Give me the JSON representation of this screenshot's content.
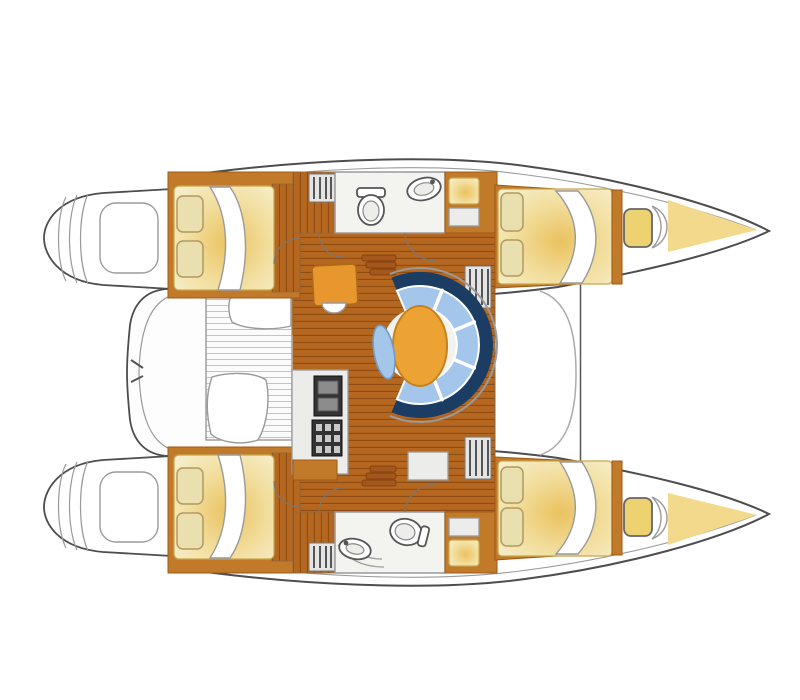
{
  "page": {
    "title": "Catamaran floor plan — top view with twin hulls, bows to the right, central saloon dinette, galley, two heads, four double berths, aft cockpit and stern swim platforms"
  },
  "colors": {
    "outline": "#4d4d4d",
    "lineLight": "#9a9a9a",
    "wood": "#b5671f",
    "woodLine": "#8f4c13",
    "trim": "#c1792a",
    "trimDark": "#a05a14",
    "mattress": "#f6ecc8",
    "mattressGlow": "#eac25f",
    "pillow": "#eadfae",
    "pillowEdge": "#b3995e",
    "sofaNavy": "#1b3c63",
    "sofaBlue": "#a4c6ea",
    "sofaBlueEdge": "#6f9cc9",
    "tableOrange": "#eda334",
    "tableEdge": "#c5821c",
    "bath": "#f3f3f0",
    "counter": "#ececea",
    "stove": "#333333",
    "stoveGrid": "#c9c9c9",
    "bowYellow": "#f3d98c",
    "hatchYellow": "#eed271",
    "benchStripe": "#c3c3c3"
  },
  "diagram": {
    "type": "boat-floor-plan",
    "vessel": "catamaran",
    "orientation": "bows-right",
    "areas": [
      {
        "id": "port-stern-swim-platform",
        "label": "Port stern swim platform with transom steps"
      },
      {
        "id": "starboard-stern-swim-platform",
        "label": "Starboard stern swim platform with transom steps"
      },
      {
        "id": "cockpit",
        "label": "Aft cockpit with slatted bench and two seats"
      },
      {
        "id": "saloon",
        "label": "Central saloon with teak plank sole"
      },
      {
        "id": "dinette",
        "label": "Curved dinette: navy-backed blue sofa, oval orange table, blue stool"
      },
      {
        "id": "chart-table",
        "label": "Chart table with white stool"
      },
      {
        "id": "galley",
        "label": "Galley with cooker, oven and counters"
      },
      {
        "id": "port-head",
        "label": "Port head: toilet and washbasin"
      },
      {
        "id": "starboard-head",
        "label": "Starboard head: toilet, washbasin and shower"
      },
      {
        "id": "port-aft-cabin",
        "label": "Port aft cabin, double berth with two pillows"
      },
      {
        "id": "starboard-aft-cabin",
        "label": "Starboard aft cabin, double berth with two pillows"
      },
      {
        "id": "port-forward-cabin",
        "label": "Port forward cabin, double berth with two pillows"
      },
      {
        "id": "starboard-forward-cabin",
        "label": "Starboard forward cabin, double berth with two pillows"
      },
      {
        "id": "companionway-steps",
        "label": "Companionway steps from saloon down into each hull"
      },
      {
        "id": "bow-lockers",
        "label": "Bow locker hatches and yellow bow storage"
      },
      {
        "id": "mast-beam",
        "label": "Forward crossbeam line between the bows"
      }
    ]
  }
}
